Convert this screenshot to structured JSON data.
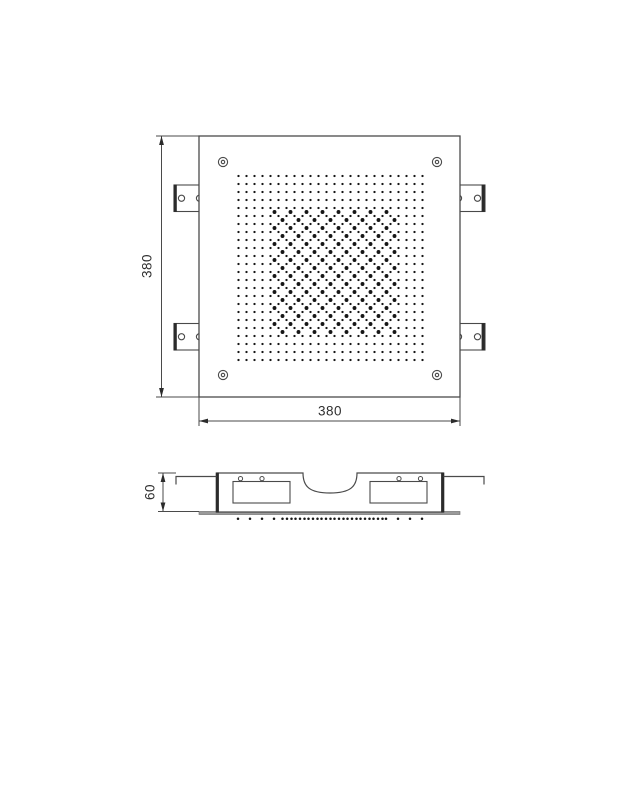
{
  "dimensions": {
    "top_width_label": "380",
    "top_height_label": "380",
    "side_height_label": "60"
  },
  "style": {
    "line_color": "#4a4a4a",
    "dark_color": "#2b2b2b",
    "dot_color": "#161616",
    "flange_color": "#9a9a9a",
    "background": "#ffffff"
  }
}
